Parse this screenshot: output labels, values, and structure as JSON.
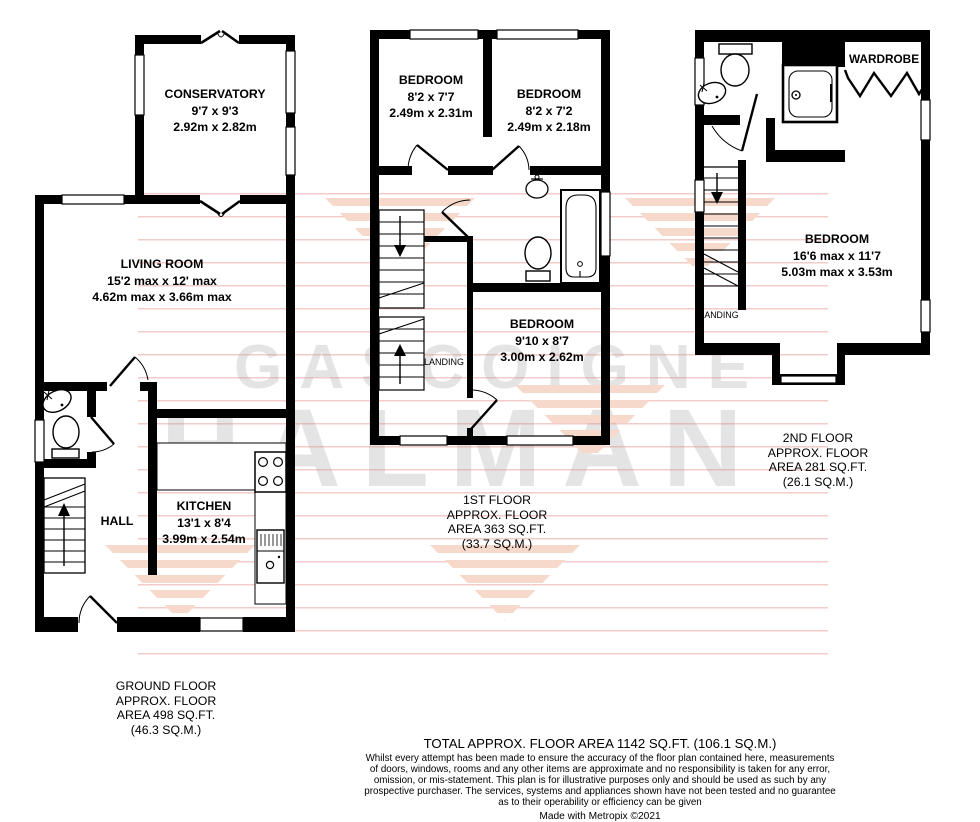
{
  "watermark": {
    "line1": "GASCOIGNE",
    "line2": "HALMAN"
  },
  "floors": {
    "ground": {
      "conservatory": {
        "name": "CONSERVATORY",
        "imperial": "9'7 x 9'3",
        "metric": "2.92m x 2.82m"
      },
      "living": {
        "name": "LIVING ROOM",
        "imperial": "15'2 max x 12' max",
        "metric": "4.62m max x 3.66m max"
      },
      "hall": {
        "name": "HALL"
      },
      "kitchen": {
        "name": "KITCHEN",
        "imperial": "13'1 x 8'4",
        "metric": "3.99m x 2.54m"
      },
      "area_label": [
        "GROUND FLOOR",
        "APPROX. FLOOR",
        "AREA 498 SQ.FT.",
        "(46.3 SQ.M.)"
      ]
    },
    "first": {
      "bedroom1": {
        "name": "BEDROOM",
        "imperial": "8'2 x 7'7",
        "metric": "2.49m x 2.31m"
      },
      "bedroom2": {
        "name": "BEDROOM",
        "imperial": "8'2 x 7'2",
        "metric": "2.49m x 2.18m"
      },
      "bedroom3": {
        "name": "BEDROOM",
        "imperial": "9'10 x 8'7",
        "metric": "3.00m x 2.62m"
      },
      "landing": {
        "name": "LANDING"
      },
      "area_label": [
        "1ST FLOOR",
        "APPROX. FLOOR",
        "AREA 363 SQ.FT.",
        "(33.7 SQ.M.)"
      ]
    },
    "second": {
      "bedroom": {
        "name": "BEDROOM",
        "imperial": "16'6 max x 11'7",
        "metric": "5.03m max x 3.53m"
      },
      "landing": {
        "name": "LANDING"
      },
      "wardrobe": {
        "name": "WARDROBE"
      },
      "area_label": [
        "2ND FLOOR",
        "APPROX. FLOOR",
        "AREA 281 SQ.FT.",
        "(26.1 SQ.M.)"
      ]
    }
  },
  "footer": {
    "total": "TOTAL APPROX. FLOOR AREA 1142 SQ.FT. (106.1 SQ.M.)",
    "disclaimer": [
      "Whilst every attempt has been made to ensure the accuracy of the floor plan contained here, measurements",
      "of doors, windows, rooms and any other items are approximate and no responsibility is taken for any error,",
      "omission, or mis-statement. This plan is for illustrative purposes only and should be used as such by any",
      "prospective purchaser. The services, systems and appliances shown have not been tested and no guarantee",
      "as to their operability or efficiency can be given"
    ],
    "credit": "Made with Metropix ©2021"
  },
  "colors": {
    "wall": "#000000",
    "watermark_text": "#e4e4e4",
    "watermark_stripe": "#f7d9cc",
    "watermark_line": "#e07a70"
  }
}
